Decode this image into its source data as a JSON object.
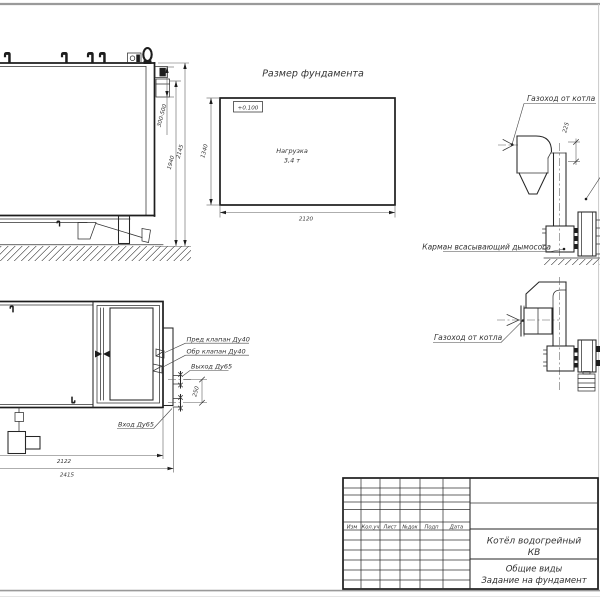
{
  "side_view": {
    "dim_flue_height": "300-500",
    "dim_body_height": "1940",
    "dim_total_height": "2145"
  },
  "foundation_plan": {
    "title": "Размер фундамента",
    "elevation_mark": "+0.100",
    "load_label": "Нагрузка",
    "load_value": "3,4 т",
    "dim_length": "2120",
    "dim_width": "1340"
  },
  "flue_side_view": {
    "duct_label": "Газоход от котла",
    "dim_offset": "225",
    "pocket_label": "Карман всасывающий дымососа"
  },
  "flue_plan_view": {
    "duct_label": "Газоход от котла"
  },
  "boiler_plan_view": {
    "safety_valve_label": "Пред клапан Ду40",
    "check_valve_label": "Обр клапан Ду40",
    "outlet_label": "Выход Ду65",
    "inlet_label": "Вход Ду65",
    "dim_pipe_spacing": "250",
    "dim_body_length": "2122",
    "dim_total_length": "2415"
  },
  "title_block": {
    "columns": [
      "Изм",
      "Кол.уч",
      "Лист",
      "№док",
      "Подп",
      "Дата"
    ],
    "product_line1": "Котёл водогрейный",
    "product_line2": "КВ",
    "doc_line1": "Общие виды",
    "doc_line2": "Задание на фундамент"
  }
}
